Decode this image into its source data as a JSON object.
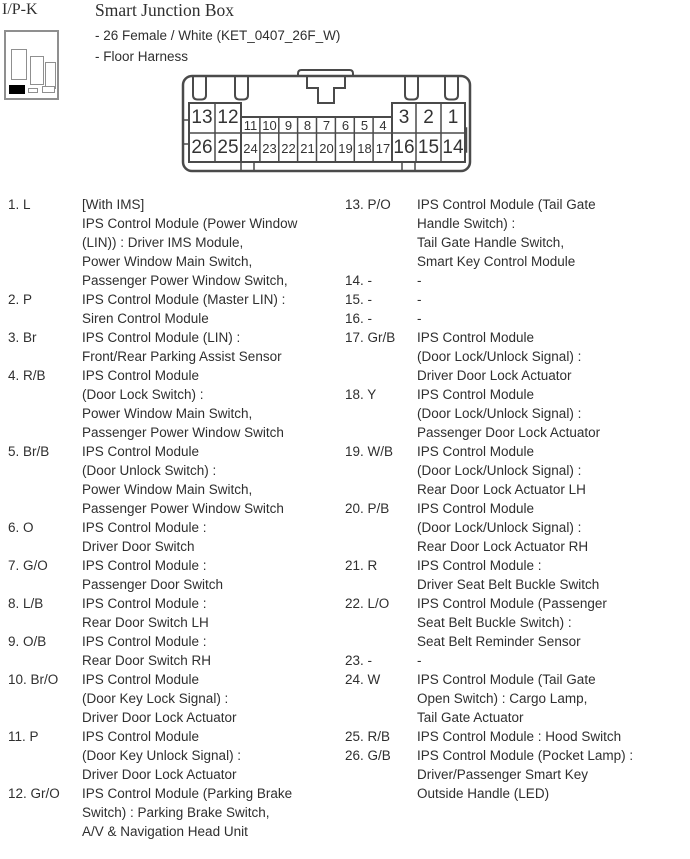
{
  "header": {
    "connector_id": "I/P-K",
    "title": "Smart Junction Box",
    "subtitle1": "- 26 Female / White (KET_0407_26F_W)",
    "subtitle2": "- Floor Harness"
  },
  "connector": {
    "top_row": [
      "13",
      "12",
      "11",
      "10",
      "9",
      "8",
      "7",
      "6",
      "5",
      "4",
      "3",
      "2",
      "1"
    ],
    "bottom_row": [
      "26",
      "25",
      "24",
      "23",
      "22",
      "21",
      "20",
      "19",
      "18",
      "17",
      "16",
      "15",
      "14"
    ],
    "stroke_color": "#4a4a4a"
  },
  "pins": {
    "left": [
      {
        "pin": "1. L",
        "desc": "[With IMS]\nIPS Control Module (Power Window\n(LIN)) : Driver IMS Module,\nPower Window Main Switch,\nPassenger Power Window Switch,"
      },
      {
        "pin": "2. P",
        "desc": "IPS Control Module (Master LIN) :\nSiren Control Module"
      },
      {
        "pin": "3. Br",
        "desc": "IPS Control Module (LIN) :\nFront/Rear Parking Assist Sensor"
      },
      {
        "pin": "4. R/B",
        "desc": "IPS Control Module\n(Door Lock Switch) :\nPower Window Main Switch,\nPassenger Power Window Switch"
      },
      {
        "pin": "5. Br/B",
        "desc": "IPS Control Module\n(Door Unlock Switch) :\nPower Window Main Switch,\nPassenger Power Window Switch"
      },
      {
        "pin": "6. O",
        "desc": "IPS Control Module :\nDriver Door Switch"
      },
      {
        "pin": "7. G/O",
        "desc": "IPS Control Module :\nPassenger Door Switch"
      },
      {
        "pin": "8. L/B",
        "desc": "IPS Control Module :\nRear Door Switch LH"
      },
      {
        "pin": "9. O/B",
        "desc": "IPS Control Module :\nRear Door Switch RH"
      },
      {
        "pin": "10. Br/O",
        "desc": "IPS Control Module\n(Door Key Lock Signal) :\nDriver Door Lock Actuator"
      },
      {
        "pin": "11. P",
        "desc": "IPS Control Module\n(Door Key Unlock Signal) :\nDriver Door Lock Actuator"
      },
      {
        "pin": "12. Gr/O",
        "desc": "IPS Control Module (Parking Brake\nSwitch) : Parking Brake Switch,\nA/V & Navigation Head Unit"
      }
    ],
    "right": [
      {
        "pin": "13. P/O",
        "desc": "IPS Control Module (Tail Gate\nHandle Switch) :\nTail Gate Handle Switch,\nSmart Key Control Module"
      },
      {
        "pin": "14. -",
        "desc": "-"
      },
      {
        "pin": "15. -",
        "desc": "-"
      },
      {
        "pin": "16. -",
        "desc": "-"
      },
      {
        "pin": "17. Gr/B",
        "desc": "IPS Control Module\n(Door Lock/Unlock Signal) :\nDriver Door Lock Actuator"
      },
      {
        "pin": "18. Y",
        "desc": "IPS Control Module\n(Door Lock/Unlock Signal) :\nPassenger Door Lock Actuator"
      },
      {
        "pin": "19. W/B",
        "desc": "IPS Control Module\n(Door Lock/Unlock Signal) :\nRear Door Lock Actuator LH"
      },
      {
        "pin": "20. P/B",
        "desc": "IPS Control Module\n(Door Lock/Unlock Signal) :\nRear Door Lock Actuator RH"
      },
      {
        "pin": "21. R",
        "desc": "IPS Control Module :\nDriver Seat Belt Buckle Switch"
      },
      {
        "pin": "22. L/O",
        "desc": "IPS Control Module (Passenger\nSeat Belt Buckle Switch) :\nSeat Belt Reminder Sensor"
      },
      {
        "pin": "23. -",
        "desc": "-"
      },
      {
        "pin": "24. W",
        "desc": "IPS Control Module (Tail Gate\nOpen Switch) : Cargo Lamp,\nTail Gate Actuator"
      },
      {
        "pin": "25. R/B",
        "desc": "IPS Control Module : Hood Switch"
      },
      {
        "pin": "26. G/B",
        "desc": "IPS Control Module (Pocket Lamp) :\nDriver/Passenger Smart Key\nOutside Handle (LED)"
      }
    ]
  }
}
